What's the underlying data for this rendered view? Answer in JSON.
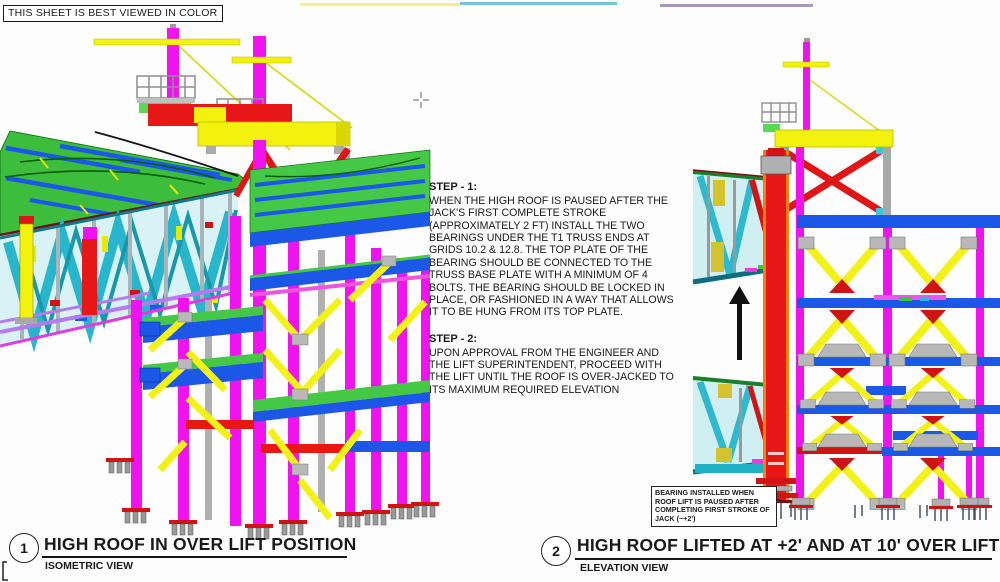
{
  "sheet": {
    "notice": "THIS SHEET IS BEST VIEWED IN COLOR"
  },
  "instructions": {
    "step1": {
      "title": "STEP - 1:",
      "body": "WHEN THE HIGH ROOF IS PAUSED AFTER THE JACK'S FIRST COMPLETE STROKE (APPROXIMATELY 2 FT) INSTALL THE TWO BEARINGS UNDER THE T1 TRUSS ENDS AT GRIDS 10.2 & 12.8. THE TOP PLATE OF THE BEARING SHOULD BE CONNECTED TO THE TRUSS BASE PLATE WITH A MINIMUM OF 4 BOLTS.  THE BEARING SHOULD BE LOCKED IN PLACE, OR FASHIONED IN A WAY THAT ALLOWS IT TO BE HUNG FROM ITS TOP PLATE."
    },
    "step2": {
      "title": "STEP - 2:",
      "body": "UPON APPROVAL FROM THE ENGINEER AND THE LIFT SUPERINTENDENT, PROCEED WITH THE LIFT UNTIL THE ROOF IS OVER-JACKED TO ITS MAXIMUM REQUIRED ELEVATION"
    }
  },
  "views": {
    "view1": {
      "number": "1",
      "title": "HIGH ROOF IN OVER LIFT POSITION",
      "subtitle": "ISOMETRIC VIEW"
    },
    "view2": {
      "number": "2",
      "title": "HIGH ROOF LIFTED AT +2' AND AT 10' OVER LIFT",
      "subtitle": "ELEVATION VIEW"
    }
  },
  "callout": {
    "text": "BEARING INSTALLED WHEN ROOF LIFT IS PAUSED AFTER COMPLETING FIRST STROKE OF JACK (~+2')"
  },
  "palette": {
    "magenta": "#F013F0",
    "yellow": "#F2F20C",
    "blue": "#1B58E8",
    "cyan": "#28B6CC",
    "green": "#3CBE3C",
    "red": "#E81717",
    "orange": "#F08010",
    "gray": "#ABABAB",
    "violet": "#B37BEE"
  }
}
